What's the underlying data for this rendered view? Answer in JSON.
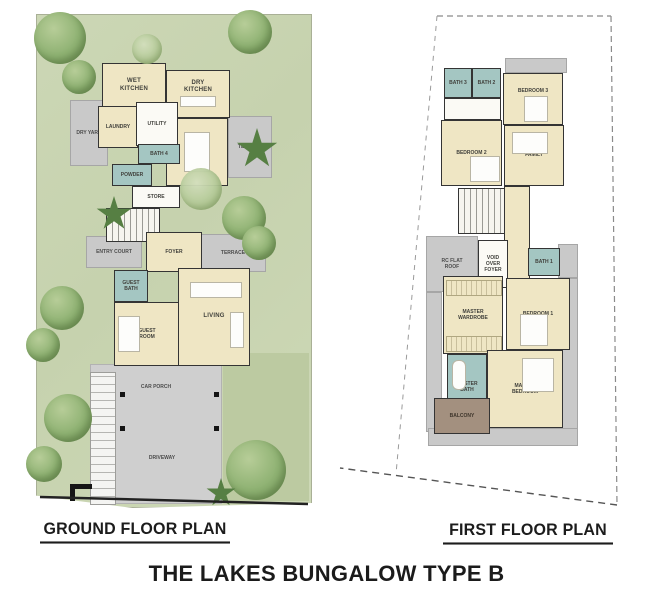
{
  "title": "THE LAKES BUNGALOW TYPE B",
  "ground_floor": {
    "caption": "GROUND FLOOR PLAN",
    "rooms": {
      "wet_kitchen": "WET KITCHEN",
      "dry_kitchen": "DRY KITCHEN",
      "laundry": "LAUNDRY",
      "dry_yard": "DRY YARD",
      "utility": "UTILITY",
      "bath4": "BATH 4",
      "powder": "POWDER",
      "store": "STORE",
      "dining": "DINING",
      "terrace_upper": "TERRACE",
      "entry_court": "ENTRY COURT",
      "foyer": "FOYER",
      "terrace_lower": "TERRACE",
      "guest_bath": "GUEST BATH",
      "guest_room": "GUEST ROOM",
      "living": "LIVING",
      "car_porch": "CAR PORCH",
      "driveway": "DRIVEWAY"
    }
  },
  "first_floor": {
    "caption": "FIRST FLOOR PLAN",
    "rooms": {
      "bath3": "BATH 3",
      "bath2": "BATH 2",
      "bedroom3": "BEDROOM 3",
      "bedroom2": "BEDROOM 2",
      "family": "FAMILY",
      "rc_flat_roof": "RC FLAT ROOF",
      "void_over_foyer": "VOID OVER FOYER",
      "bath1": "BATH 1",
      "master_wardrobe": "MASTER WARDROBE",
      "bedroom1": "BEDROOM 1",
      "master_bath": "MASTER BATH",
      "master_bedroom": "MASTER BEDROOM",
      "balcony": "BALCONY"
    }
  },
  "colors": {
    "lawn_green": "#ccd7b5",
    "room_cream": "#efe6c4",
    "bath_teal": "#a4c6c2",
    "hardscape_grey": "#c9c9c9",
    "balcony_brown": "#a3907f",
    "wall_black": "#343434"
  }
}
